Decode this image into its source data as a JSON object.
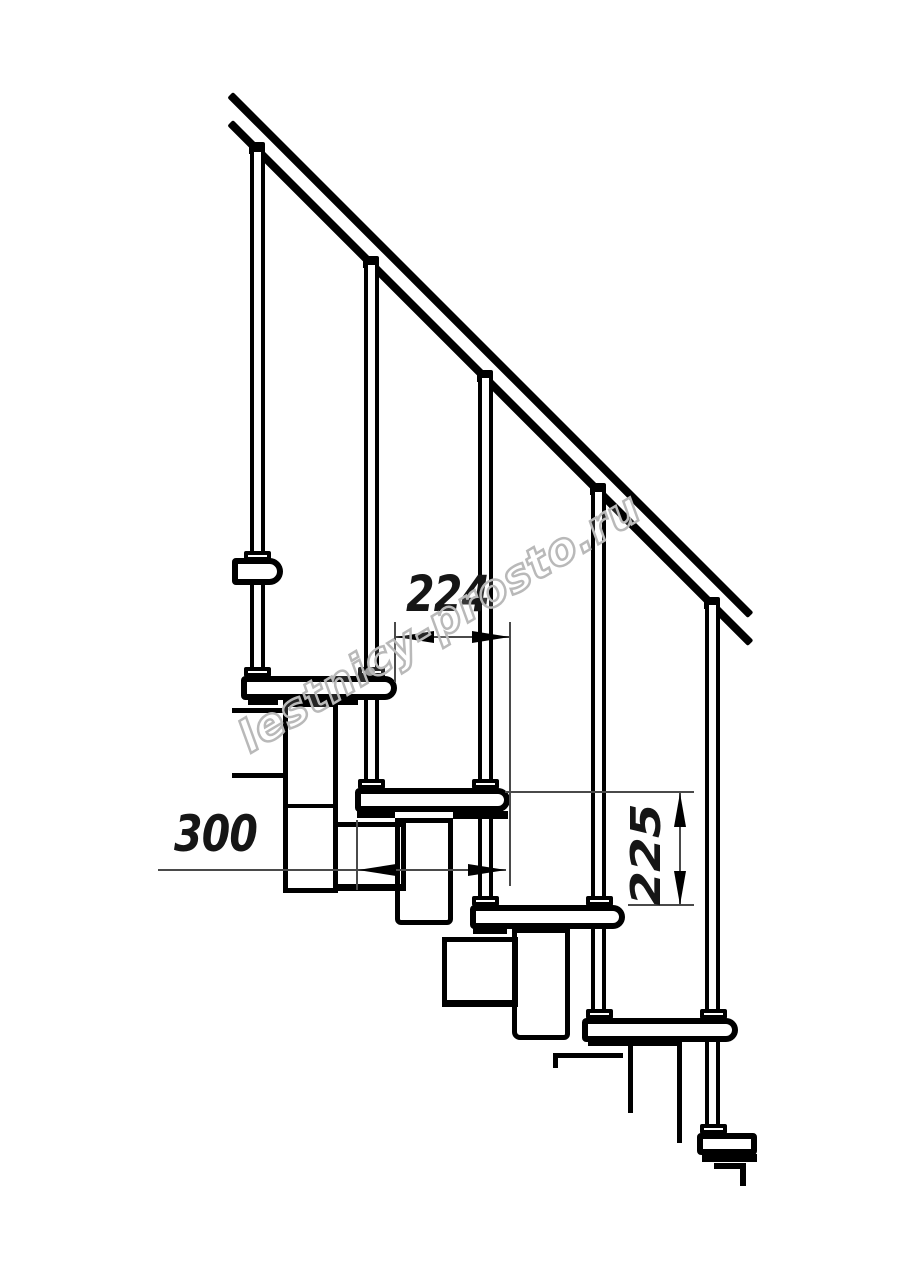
{
  "drawing": {
    "description": "Side-view technical drawing of a modular staircase",
    "watermark": "lestnicy-prosto.ru",
    "dimensions": {
      "going": "224",
      "depth": "300",
      "rise": "225"
    },
    "colors": {
      "line": "#000000",
      "dimension_line": "#4a4a4a",
      "watermark": "#b9b9b9",
      "background": "#ffffff"
    }
  }
}
